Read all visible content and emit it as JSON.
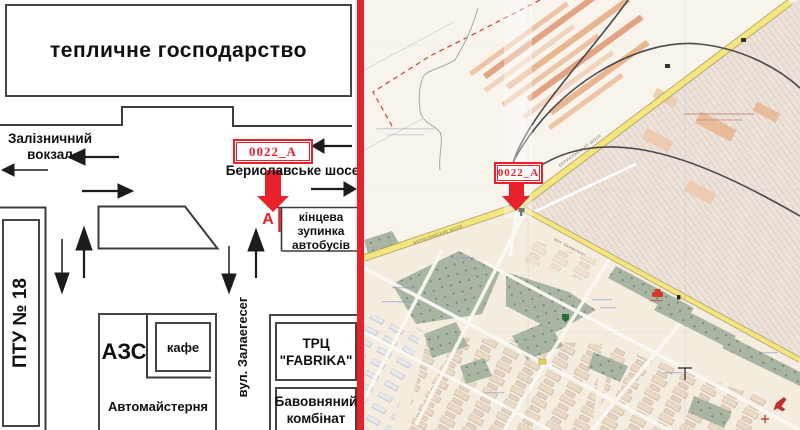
{
  "left_diagram": {
    "greenhouse_label": "тепличне господарство",
    "railway_station_line1": "Залізничний",
    "railway_station_line2": "вокзал",
    "billboard_code": "0022_A",
    "highway_label": "Бериславське шосе",
    "marker_letter": "А",
    "bus_stop_line1": "кінцева",
    "bus_stop_line2": "зупинка",
    "bus_stop_line3": "автобусів",
    "school_label": "ПТУ № 18",
    "gas_station_label": "АЗС",
    "cafe_label": "кафе",
    "auto_repair_label": "Автомайстерня",
    "street_label": "вул. Залаегесег",
    "mall_line1": "ТРЦ",
    "mall_line2": "\"FABRIKA\"",
    "cotton_line1": "Бавовняний",
    "cotton_line2": "комбінат"
  },
  "map": {
    "billboard_code": "0022_A",
    "road_label_main": "БЕРИСЛАВСЬКЕ ШОСЕ",
    "road_label_branch": "вул. Залаегесег"
  },
  "colors": {
    "accent_red": "#e8212b",
    "road_yellow": "#f5e57d",
    "park_green": "#a9b5a3",
    "industrial_pink": "#ece2da",
    "strip_salmon": "#e8b68f",
    "line_dark": "#454545"
  }
}
